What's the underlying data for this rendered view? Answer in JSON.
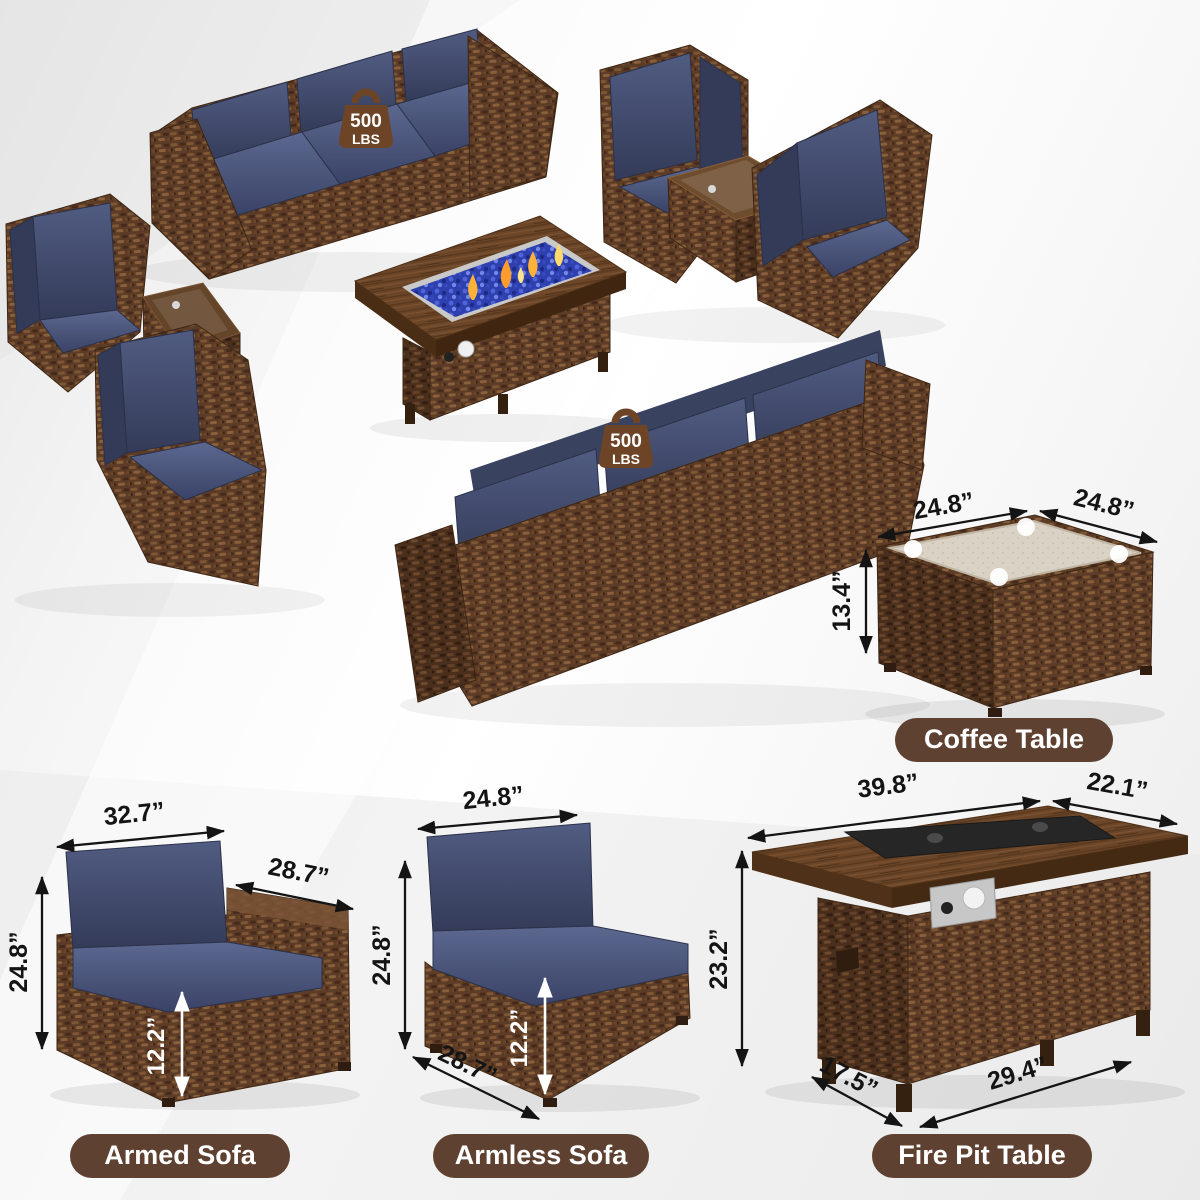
{
  "weight_badge": {
    "value": "500",
    "unit": "LBS"
  },
  "pills": {
    "coffee_table": "Coffee Table",
    "armed_sofa": "Armed Sofa",
    "armless_sofa": "Armless Sofa",
    "fire_pit_table": "Fire Pit Table"
  },
  "dimensions": {
    "coffee_table": {
      "width": "24.8”",
      "depth": "24.8”",
      "height": "13.4”"
    },
    "armed_sofa": {
      "width": "32.7”",
      "arm_depth": "28.7”",
      "height": "24.8”",
      "seat_height": "12.2”"
    },
    "armless_sofa": {
      "width": "24.8”",
      "height": "24.8”",
      "seat_height": "12.2”",
      "depth": "28.7”"
    },
    "fire_pit_table": {
      "top_width": "39.8”",
      "top_depth": "22.1”",
      "height": "23.2”",
      "base_depth": "17.5”",
      "base_width": "29.4”"
    }
  },
  "colors": {
    "pill_background": "#5e4130",
    "cushion_navy": "#3d4667",
    "wicker_brown": "#5c3c26",
    "fire_glass_blue": "#2e3fae",
    "flame_orange": "#ffb238"
  }
}
